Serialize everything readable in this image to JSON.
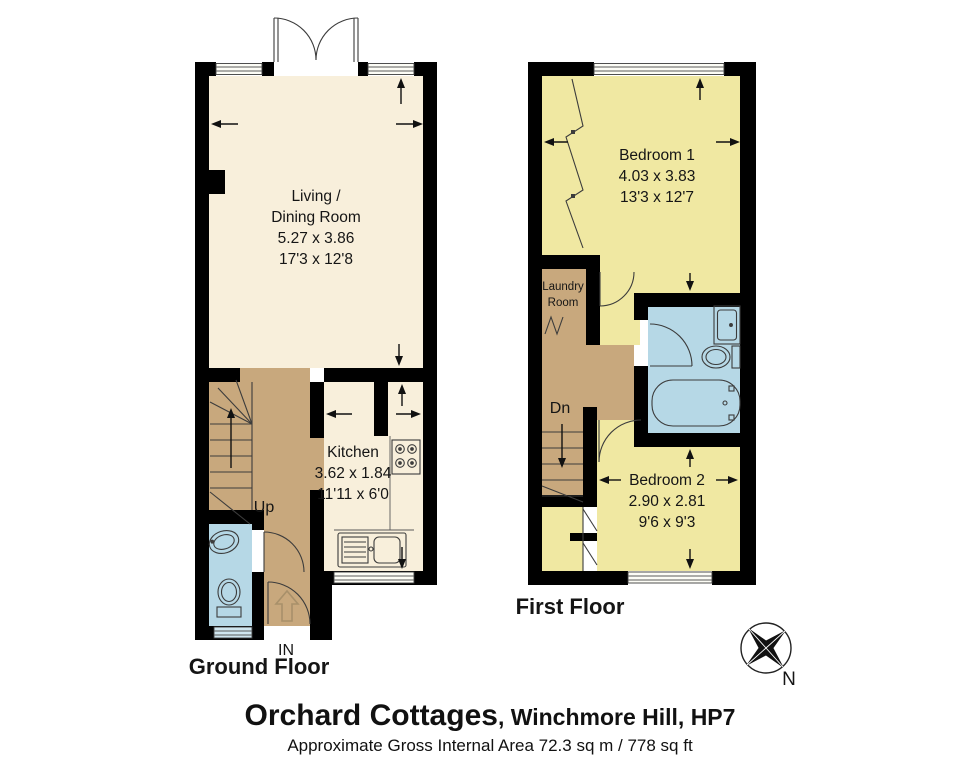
{
  "colors": {
    "wall": "#000000",
    "cream": "#f8efdb",
    "yellow": "#f0e8a2",
    "tan": "#c8a87d",
    "blue": "#b6d8e6",
    "arrow_tan": "#a8906a"
  },
  "ground_floor": {
    "label": "Ground Floor",
    "living": {
      "line1": "Living /",
      "line2": "Dining Room",
      "metric": "5.27 x 3.86",
      "imperial": "17'3 x 12'8"
    },
    "kitchen": {
      "label": "Kitchen",
      "metric": "3.62 x 1.84",
      "imperial": "11'11 x 6'0"
    },
    "stairs_label": "Up",
    "entrance_label": "IN"
  },
  "first_floor": {
    "label": "First Floor",
    "bedroom1": {
      "label": "Bedroom 1",
      "metric": "4.03 x 3.83",
      "imperial": "13'3 x 12'7"
    },
    "bedroom2": {
      "label": "Bedroom 2",
      "metric": "2.90 x 2.81",
      "imperial": "9'6 x 9'3"
    },
    "laundry": {
      "line1": "Laundry",
      "line2": "Room"
    },
    "stairs_label": "Dn"
  },
  "compass": {
    "label": "N"
  },
  "footer": {
    "title": "Orchard Cottages",
    "subtitle": ", Winchmore Hill, HP7",
    "area": "Approximate Gross Internal Area 72.3 sq m / 778 sq ft"
  }
}
